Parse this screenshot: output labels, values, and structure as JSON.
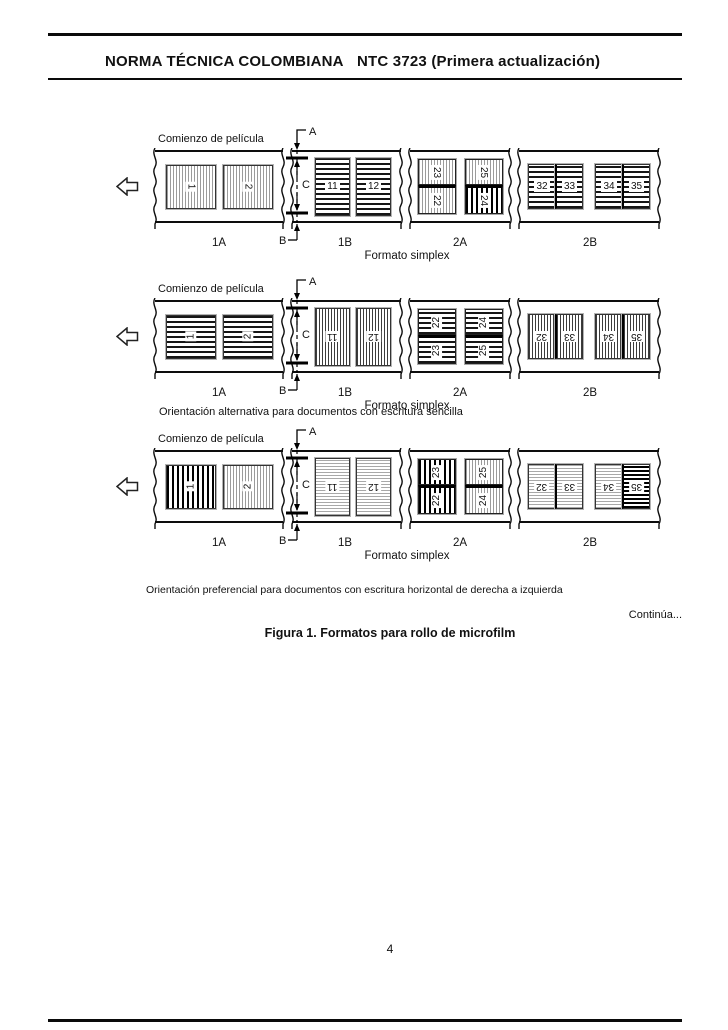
{
  "header": {
    "left": "NORMA TÉCNICA COLOMBIANA",
    "right": "NTC 3723 (Primera actualización)"
  },
  "figure": {
    "caption": "Figura 1. Formatos para rollo de microfilm",
    "continues": "Continúa...",
    "note_alternative": "Orientación alternativa para documentos con escritura sencilla",
    "note_preferential": "Orientación preferencial para documentos con escritura horizontal de derecha a izquierda"
  },
  "page_number": "4",
  "strips": [
    {
      "film_start_label": "Comienzo de película",
      "format_label": "Formato simplex",
      "markers": {
        "a": "A",
        "b": "B",
        "c": "C"
      },
      "sections": [
        {
          "label": "1A",
          "kind": "single",
          "frames": [
            {
              "n": "1",
              "fill": "v-light",
              "rot": 90,
              "shape": "landscape"
            },
            {
              "n": "2",
              "fill": "v-light",
              "rot": 90,
              "shape": "landscape"
            }
          ]
        },
        {
          "label": "1B",
          "kind": "single",
          "frames": [
            {
              "n": "11",
              "fill": "h-dark",
              "rot": 0,
              "shape": "portrait"
            },
            {
              "n": "12",
              "fill": "h-dark",
              "rot": 0,
              "shape": "portrait"
            }
          ]
        },
        {
          "label": "2A",
          "kind": "duplex",
          "columns": [
            {
              "top": {
                "n": "23",
                "fill": "v-light",
                "rot": 90
              },
              "bottom": {
                "n": "22",
                "fill": "v-light",
                "rot": 90
              }
            },
            {
              "top": {
                "n": "25",
                "fill": "v-light",
                "rot": 90
              },
              "bottom": {
                "n": "24",
                "fill": "v-heavy",
                "rot": 90
              }
            }
          ]
        },
        {
          "label": "2B",
          "kind": "pairs",
          "pairs": [
            [
              {
                "n": "32",
                "fill": "h-dark",
                "rot": 0,
                "shape": "small"
              },
              {
                "n": "33",
                "fill": "h-dark",
                "rot": 0,
                "shape": "small"
              }
            ],
            [
              {
                "n": "34",
                "fill": "h-dark",
                "rot": 0,
                "shape": "small"
              },
              {
                "n": "35",
                "fill": "h-dark",
                "rot": 0,
                "shape": "small"
              }
            ]
          ]
        }
      ]
    },
    {
      "film_start_label": "Comienzo de película",
      "format_label": "Formato simplex",
      "markers": {
        "a": "A",
        "b": "B",
        "c": "C"
      },
      "sections": [
        {
          "label": "1A",
          "kind": "single",
          "frames": [
            {
              "n": "1",
              "fill": "h-dark",
              "rot": -90,
              "shape": "landscape"
            },
            {
              "n": "2",
              "fill": "h-dark",
              "rot": -90,
              "shape": "landscape"
            }
          ]
        },
        {
          "label": "1B",
          "kind": "single",
          "frames": [
            {
              "n": "11",
              "fill": "v-dark",
              "rot": 180,
              "shape": "portrait"
            },
            {
              "n": "12",
              "fill": "v-dark",
              "rot": 180,
              "shape": "portrait"
            }
          ]
        },
        {
          "label": "2A",
          "kind": "duplex",
          "columns": [
            {
              "top": {
                "n": "22",
                "fill": "h-dark",
                "rot": -90
              },
              "bottom": {
                "n": "23",
                "fill": "h-dark",
                "rot": -90
              }
            },
            {
              "top": {
                "n": "24",
                "fill": "h-dark",
                "rot": -90
              },
              "bottom": {
                "n": "25",
                "fill": "h-dark",
                "rot": -90
              }
            }
          ]
        },
        {
          "label": "2B",
          "kind": "pairs",
          "pairs": [
            [
              {
                "n": "32",
                "fill": "v-dark",
                "rot": 180,
                "shape": "small"
              },
              {
                "n": "33",
                "fill": "v-dark",
                "rot": 180,
                "shape": "small"
              }
            ],
            [
              {
                "n": "34",
                "fill": "v-dark",
                "rot": 180,
                "shape": "small"
              },
              {
                "n": "35",
                "fill": "v-dark",
                "rot": 180,
                "shape": "small"
              }
            ]
          ]
        }
      ]
    },
    {
      "film_start_label": "Comienzo de película",
      "format_label": "Formato simplex",
      "markers": {
        "a": "A",
        "b": "B",
        "c": "C"
      },
      "sections": [
        {
          "label": "1A",
          "kind": "single",
          "frames": [
            {
              "n": "1",
              "fill": "v-heavy",
              "rot": -90,
              "shape": "landscape"
            },
            {
              "n": "2",
              "fill": "v-light",
              "rot": -90,
              "shape": "landscape"
            }
          ]
        },
        {
          "label": "1B",
          "kind": "single",
          "frames": [
            {
              "n": "11",
              "fill": "h-light",
              "rot": 180,
              "shape": "portrait"
            },
            {
              "n": "12",
              "fill": "h-light",
              "rot": 180,
              "shape": "portrait"
            }
          ]
        },
        {
          "label": "2A",
          "kind": "duplex",
          "columns": [
            {
              "top": {
                "n": "23",
                "fill": "v-heavy",
                "rot": -90
              },
              "bottom": {
                "n": "22",
                "fill": "v-heavy",
                "rot": -90
              }
            },
            {
              "top": {
                "n": "25",
                "fill": "v-light",
                "rot": -90
              },
              "bottom": {
                "n": "24",
                "fill": "v-light",
                "rot": -90
              }
            }
          ]
        },
        {
          "label": "2B",
          "kind": "pairs",
          "pairs": [
            [
              {
                "n": "32",
                "fill": "h-light",
                "rot": 180,
                "shape": "small"
              },
              {
                "n": "33",
                "fill": "h-light",
                "rot": 180,
                "shape": "small"
              }
            ],
            [
              {
                "n": "34",
                "fill": "h-light",
                "rot": 180,
                "shape": "small"
              },
              {
                "n": "35",
                "fill": "h-heavy",
                "rot": 180,
                "shape": "small"
              }
            ]
          ]
        }
      ]
    }
  ]
}
